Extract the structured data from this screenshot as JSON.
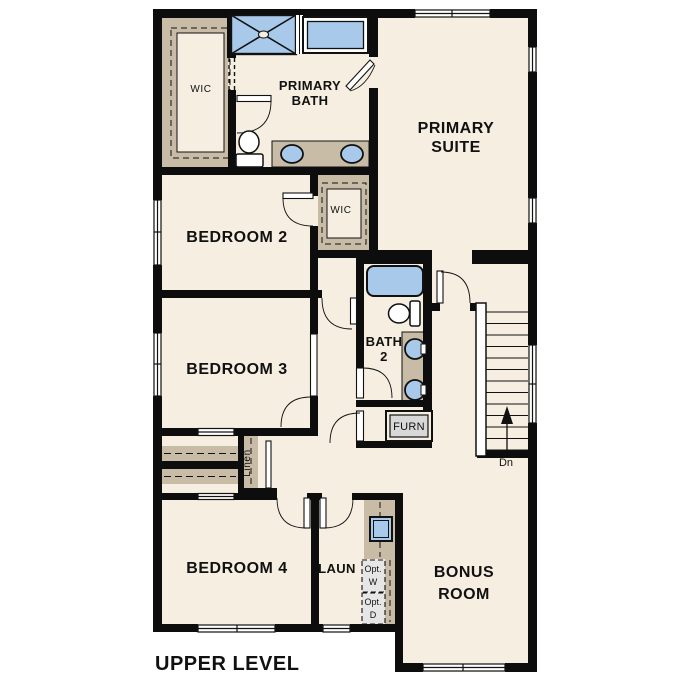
{
  "plan": {
    "title": "UPPER LEVEL"
  },
  "rooms": {
    "wic1": {
      "label": "WIC"
    },
    "primary_bath": {
      "line1": "PRIMARY",
      "line2": "BATH"
    },
    "primary_suite": {
      "line1": "PRIMARY",
      "line2": "SUITE"
    },
    "bedroom2": {
      "label": "BEDROOM 2"
    },
    "wic2": {
      "label": "WIC"
    },
    "bedroom3": {
      "label": "BEDROOM 3"
    },
    "bath2": {
      "line1": "BATH",
      "line2": "2"
    },
    "furnace": {
      "label": "FURN"
    },
    "linen": {
      "label": "Linen"
    },
    "bedroom4": {
      "label": "BEDROOM 4"
    },
    "laundry": {
      "label": "LAUN"
    },
    "opt_washer": {
      "line1": "Opt.",
      "line2": "W"
    },
    "opt_dryer": {
      "line1": "Opt.",
      "line2": "D"
    },
    "bonus": {
      "line1": "BONUS",
      "line2": "ROOM"
    },
    "stairs": {
      "label": "Dn"
    }
  },
  "colors": {
    "background": "#ffffff",
    "floor": "#f5eee1",
    "wall": "#0d0d0d",
    "closet_tan": "#c9bca6",
    "fixture_blue": "#a9c9ea",
    "appliance_gray": "#e6e6e6",
    "furnace_gray": "#d8d8d8"
  }
}
